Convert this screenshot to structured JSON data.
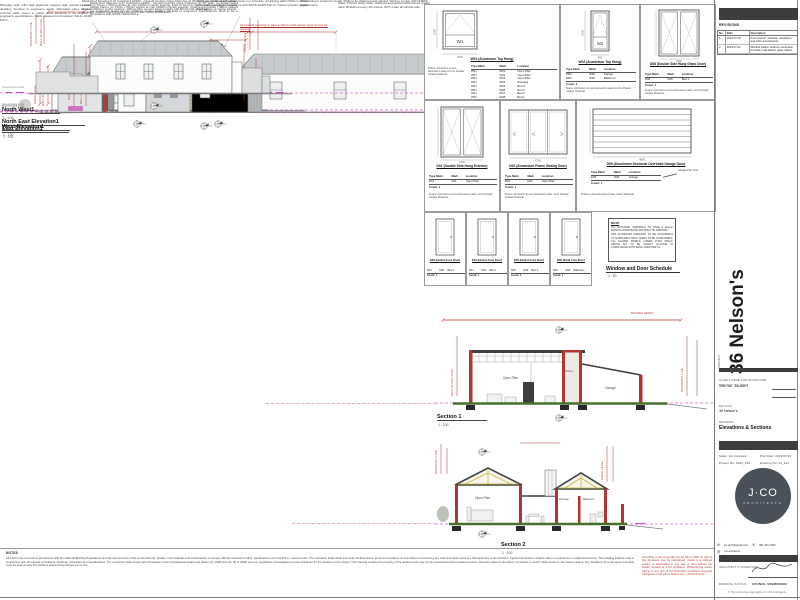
{
  "sheet": {
    "project": "36 Nelson's",
    "drawing_title": "Elevations & Sections"
  },
  "dims": {
    "ridge": "RIDGE LEVEL",
    "wallplate": "WALL PLATE LEVEL",
    "boundary": "BOUNDARY LINE",
    "height": "BUILDING HEIGHT",
    "ngl": "NGL",
    "ground": "Ground Floor Level"
  },
  "elevations": [
    {
      "label": "North East Elevation1",
      "scale": "1 : 100",
      "note": "Metal Roof Sheeting 0.47 Colorbond AZ200 - Clyvedil Country Cape Charcoal, at 30° pitch, on double sided radiant barrier, on 76mm x 50mm purlins at max 1200mm centre spacing, fixed to SA pine roof trusses to engineer's specs at max 1000mm centre spacing. 135mm fibre cement barge boards with 50mm half round gutters on fascia boards. All timber treated. Roof structure to comply with SANS 10400 Part L.",
      "note2": "Walls: 270mm cavity walls, plastered and painted with exterior quality paint. Brickforce every 4th course. DPC under all window sills.",
      "red_note": "All external openings to have a 110mm wide plaster band around the opening"
    },
    {
      "label": "East Elevation1",
      "scale": "1 : 100",
      "note": "Metal Roof Sheeting 0.47 Colorbond AZ200 - Clyvedil Country Cape Charcoal, at 30° pitch, on double sided radiant barrier, on 76mm x 50mm purlins at max 1200mm centre spacing, unskimmed trusses / rafters spaced per engineer's specs at max 1000mm centre spacing. All fixed to engineer's specifications. Roof to be in compliance with SANS 10400 Part L."
    },
    {
      "label": "West Elevation1",
      "scale": "1 : 100",
      "note": "Boundary wall: 1.8m high plastered masonry wall, painted to match dwelling, founded to engineer's detail. Rainwater pipes fixed to external walls, colour to match. Roof structure to be erected to engineer's specifications. Walls plastered and painted. SANS 10400 Part L.",
      "note2": "Aluminium windows with glass panes per schedule. All glazing within 500mm of FFL to be safety glazing in compliance with SANS 10400 Part N. Frames powder coated charcoal."
    },
    {
      "label": "North West1",
      "scale": "1 : 100",
      "note2": "All retaining to engineer's detail. Walls to be plastered and painted. Work to comply with NHBRC requirements."
    }
  ],
  "sections": [
    {
      "label": "Section 1",
      "scale": "1 : 100",
      "rooms": [
        "Open Plan",
        "Kitchen",
        "Garage"
      ]
    },
    {
      "label": "Section 2",
      "scale": "1 : 100",
      "rooms": [
        "Open Plan",
        "Passage",
        "Bathroom"
      ]
    }
  ],
  "schedule": {
    "title": "Window and Door Schedule",
    "scale": "1 : 50",
    "headers": [
      "Type Mark",
      "Mark",
      "Location"
    ],
    "cells": [
      {
        "tag": "W1",
        "title": "W01 (Aluminium Top Hung)",
        "w": "1500",
        "h": "1500",
        "rows": [
          [
            "W01",
            "W01",
            "Open Plan"
          ],
          [
            "W01",
            "W02",
            "Open Plan"
          ],
          [
            "W01",
            "W03",
            "Open Plan"
          ],
          [
            "W01",
            "W04",
            "Passage"
          ],
          [
            "W01",
            "W05",
            "Bed 3"
          ],
          [
            "W01",
            "W06",
            "Bed 3"
          ],
          [
            "W01",
            "W07",
            "Bed 2"
          ],
          [
            "W01",
            "W08",
            "Bed 1"
          ],
          [
            "W01",
            "W12",
            "Outside"
          ]
        ],
        "count": "Count: 9",
        "note": "Frame: Aluminium to own discretion's taste & to be Powder Coated Charcoal"
      },
      {
        "tag": "W2",
        "title": "W02 (Aluminium Top Hung)",
        "w": "600",
        "h": "1500",
        "rows": [
          [
            "W02",
            "W09",
            "Garage"
          ],
          [
            "W02",
            "W10",
            "Bathroom"
          ]
        ],
        "count": "Count: 2",
        "note": "Frame: Aluminium to own discretion's taste & to be Powder Coated Charcoal"
      },
      {
        "tag": "D8",
        "title": "D08 (Double Side Hung Glass Door)",
        "w": "1500",
        "h": "2100",
        "rows": [
          [
            "D08",
            "D08",
            "Bed 1"
          ]
        ],
        "count": "Count: 1",
        "note": "Frame: Aluminium to own discretion's taste, to be Powder Coated Charcoal"
      },
      {
        "tag": "D1",
        "title": "D01 (Double Side Hung Exterior)",
        "w": "1600",
        "h": "2100",
        "rows": [
          [
            "D01",
            "D01",
            "Open Plan"
          ]
        ],
        "count": "Count: 1",
        "note": "Frame: Aluminium to own discretion's taste, to be Powder Coated Charcoal"
      },
      {
        "tag": "D2",
        "title": "D02 (Aluminium Frame Sliding Door)",
        "w": "2700",
        "h": "2100",
        "rows": [
          [
            "D02",
            "D02",
            "Open Plan"
          ]
        ],
        "count": "Count: 1",
        "note": "Frame: Aluminium to own discretion's taste, to be Powder Coated Charcoal"
      },
      {
        "tag": "D9",
        "title": "D09 (Aluminium Sectional Overhead Garage Door)",
        "w": "4800",
        "h": "2100",
        "rows": [
          [
            "D09",
            "D09",
            "Garage"
          ]
        ],
        "count": "Count: 1",
        "note": "Finish to own discretion's taste, colour Charcoal",
        "leader": "Garage Plan Cont."
      },
      {
        "tag": "D3",
        "title": "D03 (Hollow Core Door)",
        "w": "813",
        "h": "2032",
        "rows": [
          [
            "D03",
            "D03",
            "Bed 1"
          ]
        ],
        "count": "Count: 1",
        "note": ""
      },
      {
        "tag": "D4",
        "title": "D04 (Hollow Core Door)",
        "w": "813",
        "h": "2032",
        "rows": [
          [
            "D04",
            "D04",
            "Bed 2"
          ]
        ],
        "count": "Count: 1",
        "note": ""
      },
      {
        "tag": "D5",
        "title": "D05 (Hollow Core Door)",
        "w": "813",
        "h": "2032",
        "rows": [
          [
            "D05",
            "D05",
            "Bed 3"
          ]
        ],
        "count": "Count: 1",
        "note": ""
      },
      {
        "tag": "D6",
        "title": "D06 (Solid Core Door)",
        "w": "813",
        "h": "2032",
        "rows": [
          [
            "D06",
            "D06",
            "Bathroom"
          ]
        ],
        "count": "Count: 1",
        "note": ""
      }
    ],
    "note_box": {
      "title": "NOTE",
      "line1": "ALL EXTERNAL OPENINGS TO HAVE A 110mm WIDE PLASTER BAND AROUND THE OPENING.",
      "line2": "SPS ALUMINIUM WINDOWS TO BE ACCORDING TO SUPPLIER'S SPEC (SIZES TO BE CONFIRMED). ALL GLAZED PANELS LOWER THAN 500mm ABOVE FFL TO BE SAFETY GLAZING IN COMPLIANCE WITH SANS 10400 PART N."
    }
  },
  "revisions": {
    "title": "REVISIONS",
    "headers": [
      "No.",
      "Date",
      "Description"
    ],
    "rows": [
      {
        "no": "1",
        "date": "2023-07-18",
        "desc": "Front dormer, windows, elevations, and other amendments."
      },
      {
        "no": "2",
        "date": "2023-07-22",
        "desc": "Window added, bedroom amended, boundary wall added, gates added."
      }
    ]
  },
  "titleblock": {
    "project_label": "PROJECT",
    "project_name": "36 Nelson's",
    "client_label": "CLIENT NAME FOR SIGNATURE",
    "client_name": "Werner Joubert",
    "details_label": "DETAILS",
    "details_value": "36 Nelson's",
    "drawing_label": "DRAWING",
    "drawing_value": "Elevations & Sections",
    "scale_label": "Scale:",
    "scale_value": "As indicated",
    "plot_date_label": "Plot Date:",
    "plot_date_value": "2023/07/22",
    "project_no_label": "Project No:",
    "project_no_value": "2023_156",
    "drawing_no_label": "Drawing No:",
    "drawing_no_value": "03_101",
    "logo_main": "J·CO",
    "logo_sub": "ARCHITECTS",
    "contact_email": "jco.arch@gmail.com",
    "contact_phone": "081 461 0383",
    "contact_social": "jco.architects",
    "signature_label": "ARCHITECT'S SIGNATURE",
    "status_label": "DRAWING STATUS",
    "status_value": "COUNCIL SUBMISSION",
    "copyright": "© The exclusive copyright of J.CO Architects"
  },
  "general_notes": {
    "title": "NOTES",
    "body": "All work to be executed in accordance with the National Building Regulations and the requirements of the Local Authority. Quality of all materials and workmanship to comply with the relevant S.A.B.S. specifications and N.H.B.R.C. requirements. The contractor shall check and verify all dimensions, levels and positions on site before commencing any work and shall report any discrepancies to the architect. Figured dimensions shall be taken in preference to scaled dimensions. This drawing shall be read in conjunction with all relevant consultants' drawings, schedules and specifications. The contractor shall comply with all aspects of the Occupational Health and Safety Act, 1993 (Act No. 85 of 1993) and any regulations promulgated in terms of that Act for the duration of the project. This drawing remains the property of the architect and may not be reproduced without written consent. All levels relate to site datum; contractor to confirm NGL levels on site before casting. Any deviations from the approved plans must be approved by the architect before being carried out on site.",
    "copyright": "According to the Copyright Act No 98 of 1978 no part of this document may be reproduced, stored in a retrieval system or transmitted in any way or form without the written consent of J.CO Architects. Photocopying and/or tracing of any part of this document constitutes copyright infringement and will be acted upon. J.CO Architects"
  }
}
